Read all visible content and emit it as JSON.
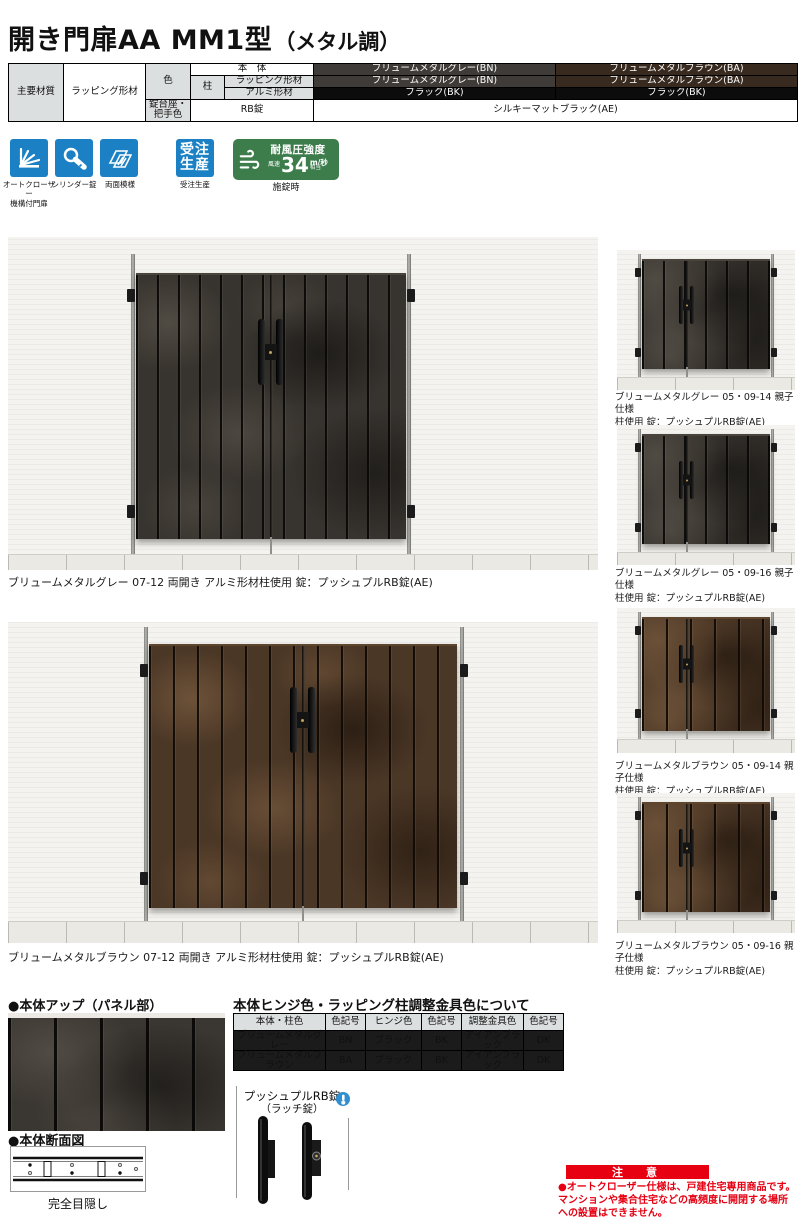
{
  "page": {
    "title_main": "開き門扉AA MM1型",
    "title_sub": "（メタル調）"
  },
  "spec_table": {
    "main_material_label": "主要材質",
    "main_material_value": "ラッピング形材",
    "color_label": "色",
    "pillar_label": "柱",
    "body_label": "本　体",
    "wrap_label": "ラッピング形材",
    "alumi_label": "アルミ形材",
    "body_gray": "ブリュームメタルグレー(BN)",
    "body_brown": "ブリュームメタルブラウン(BA)",
    "wrap_gray": "ブリュームメタルグレー(BN)",
    "wrap_brown": "ブリュームメタルブラウン(BA)",
    "alumi_gray": "ブラック(BK)",
    "alumi_brown": "ブラック(BK)",
    "lock_base_label": "錠台座・把手色",
    "lock_part_label": "RB錠",
    "lock_value": "シルキーマットブラック(AE)"
  },
  "badges": {
    "auto_closer": "オートクローザー\n機構付門扉",
    "cylinder": "シリンダー錠",
    "double_sided": "両面模様",
    "order_icon_text": "受注\n生産",
    "order_label": "受注生産",
    "wind_title": "耐風圧強度",
    "wind_prefix": "風速",
    "wind_value": "34",
    "wind_unit": "m/秒",
    "wind_suffix": "相当",
    "wind_caption": "施錠時"
  },
  "photos": {
    "main1_caption": "ブリュームメタルグレー 07-12 両開き アルミ形材柱使用 錠：プッシュプルRB錠(AE)",
    "main2_caption": "ブリュームメタルブラウン 07-12 両開き アルミ形材柱使用 錠：プッシュプルRB錠(AE)",
    "thumbs": [
      {
        "caption": "ブリュームメタルグレー 05・09-14 親子仕様\n柱使用 錠：プッシュプルRB錠(AE)"
      },
      {
        "caption": "ブリュームメタルグレー 05・09-16 親子仕様\n柱使用 錠：プッシュプルRB錠(AE)"
      },
      {
        "caption": "ブリュームメタルブラウン 05・09-14 親子仕様\n柱使用 錠：プッシュプルRB錠(AE)"
      },
      {
        "caption": "ブリュームメタルブラウン 05・09-16 親子仕様\n柱使用 錠：プッシュプルRB錠(AE)"
      }
    ]
  },
  "details": {
    "panel_title": "●本体アップ（パネル部）",
    "section_title": "●本体断面図",
    "section_caption": "完全目隠し",
    "lock_name": "プッシュプルRB錠",
    "lock_name_sub": "（ラッチ錠）"
  },
  "hinge_table": {
    "title": "本体ヒンジ色・ラッピング柱調整金具色について",
    "headers": [
      "本体・柱色",
      "色記号",
      "ヒンジ色",
      "色記号",
      "調整金具色",
      "色記号"
    ],
    "rows": [
      [
        "ブリュームメタルグレー",
        "BN",
        "ブラック",
        "BK",
        "アイアンブラック",
        "DK"
      ],
      [
        "ブリュームメタルブラウン",
        "BA",
        "ブラック",
        "BK",
        "アイアンブラック",
        "DK"
      ]
    ]
  },
  "notice": {
    "title": "注　意",
    "text": "●オートクローザー仕様は、戸建住宅専用商品です。マンションや集合住宅などの高頻度に開閉する場所への設置はできません。"
  },
  "colors": {
    "icon_blue": "#1b80c4",
    "badge_green": "#3c7d4b",
    "notice_red": "#e60012",
    "swatch_gray": "#3f3b38",
    "swatch_brown": "#382a1f",
    "swatch_black": "#0c0c0c"
  }
}
